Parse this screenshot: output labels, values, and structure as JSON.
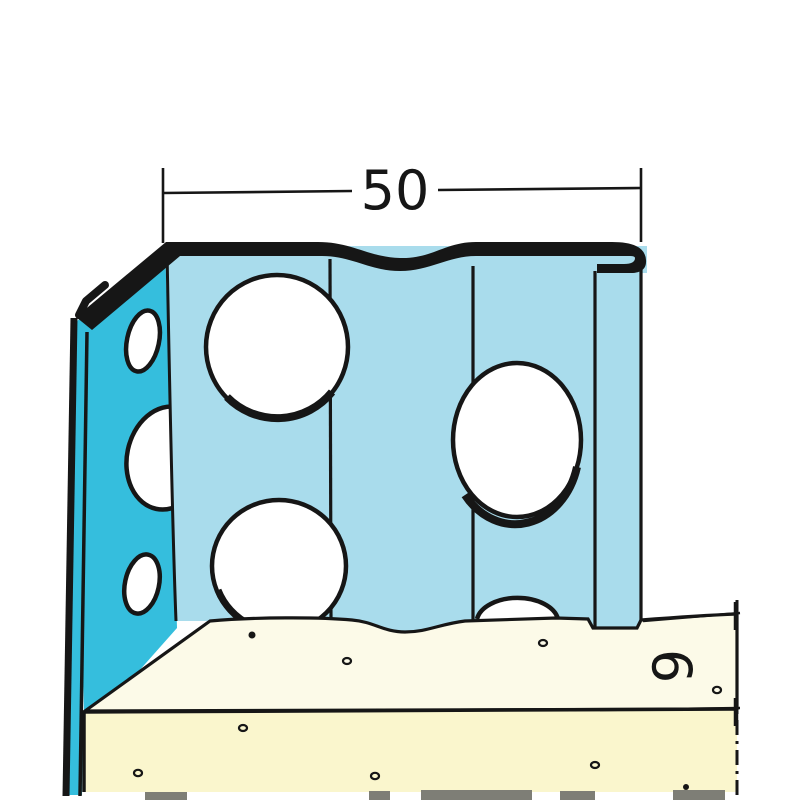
{
  "dimensions": {
    "width_label": "50",
    "thickness_label": "9"
  },
  "colors": {
    "flange_teal": "#35bedd",
    "face_blue": "#a9dcec",
    "board_cream": "#fcfae8",
    "board_yellow": "#faf6cd",
    "line_black": "#161616",
    "cut_gray": "#7e7e76"
  }
}
